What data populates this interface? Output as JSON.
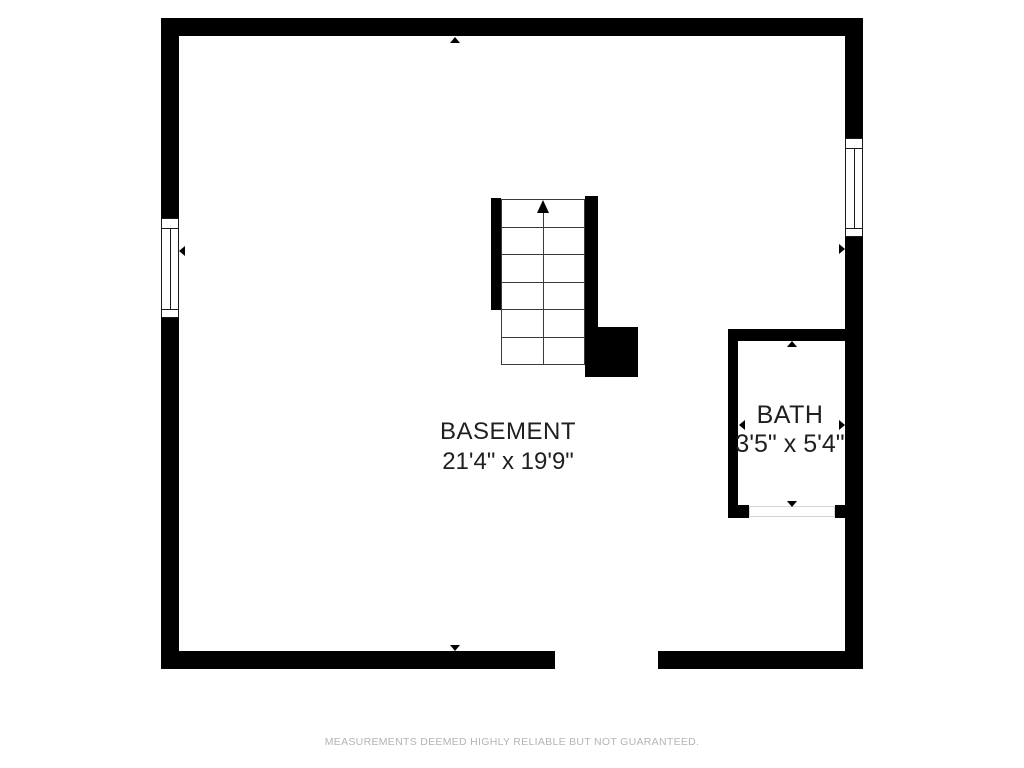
{
  "page": {
    "background": "#ffffff"
  },
  "rooms": {
    "basement": {
      "label": "BASEMENT",
      "dimensions": "21'4\" x 19'9\""
    },
    "bath": {
      "label": "BATH",
      "dimensions": "3'5\" x 5'4\""
    }
  },
  "staircase": {
    "direction": "up",
    "steps": 6
  },
  "footer": {
    "disclaimer": "MEASUREMENTS DEEMED HIGHLY RELIABLE BUT NOT GUARANTEED."
  },
  "colors": {
    "wall": "#000000",
    "room_text": "#1f1f1f",
    "disclaimer_text": "#b4b4b4",
    "stair_line": "#3a3a3a"
  }
}
